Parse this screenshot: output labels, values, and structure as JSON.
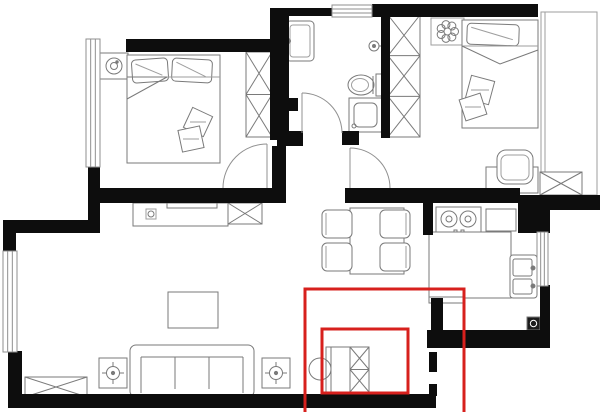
{
  "canvas": {
    "w": 600,
    "h": 412,
    "bg": "#ffffff"
  },
  "palette": {
    "wall": "#0d0d0d",
    "furniture_line": "#7a7a7a",
    "furniture_line_light": "#9e9e9e",
    "window_line": "#8f8f8f",
    "door_line": "#909090",
    "highlight": "#d7201d",
    "drain_fill": "#1c1c1c",
    "white": "#ffffff"
  },
  "walls": [
    {
      "name": "wall-bedroom1-top",
      "x": 126,
      "y": 39,
      "w": 147,
      "h": 13
    },
    {
      "name": "wall-bathroom-left",
      "x": 270,
      "y": 8,
      "w": 19,
      "h": 132
    },
    {
      "name": "wall-bathroom-left-bump",
      "x": 289,
      "y": 98,
      "w": 9,
      "h": 13
    },
    {
      "name": "wall-bathroom-top",
      "x": 289,
      "y": 8,
      "w": 44,
      "h": 8
    },
    {
      "name": "wall-top-right",
      "x": 372,
      "y": 4,
      "w": 166,
      "h": 13
    },
    {
      "name": "wall-bathroom-right",
      "x": 381,
      "y": 15,
      "w": 9,
      "h": 123
    },
    {
      "name": "wall-bathroom-bottom-left-pier",
      "x": 277,
      "y": 131,
      "w": 26,
      "h": 15
    },
    {
      "name": "wall-bathroom-bottom-right-pier",
      "x": 342,
      "y": 131,
      "w": 17,
      "h": 14
    },
    {
      "name": "wall-corridor-left-pier",
      "x": 272,
      "y": 146,
      "w": 14,
      "h": 57
    },
    {
      "name": "wall-living-top",
      "x": 97,
      "y": 188,
      "w": 189,
      "h": 15
    },
    {
      "name": "wall-bedroom1-left-lower",
      "x": 88,
      "y": 165,
      "w": 12,
      "h": 55
    },
    {
      "name": "wall-left-step",
      "x": 3,
      "y": 220,
      "w": 97,
      "h": 13
    },
    {
      "name": "wall-left-above-window",
      "x": 3,
      "y": 233,
      "w": 13,
      "h": 20
    },
    {
      "name": "wall-left-below-window",
      "x": 8,
      "y": 351,
      "w": 14,
      "h": 49
    },
    {
      "name": "wall-bottom",
      "x": 8,
      "y": 394,
      "w": 428,
      "h": 14
    },
    {
      "name": "wall-entry-jamb-upper",
      "x": 429,
      "y": 352,
      "w": 8,
      "h": 20
    },
    {
      "name": "wall-entry-jamb-lower",
      "x": 429,
      "y": 384,
      "w": 8,
      "h": 12
    },
    {
      "name": "wall-bedroom2-bottom",
      "x": 345,
      "y": 188,
      "w": 175,
      "h": 15
    },
    {
      "name": "wall-balcony-bottom",
      "x": 518,
      "y": 195,
      "w": 82,
      "h": 15
    },
    {
      "name": "wall-kitchen-corner-block",
      "x": 518,
      "y": 203,
      "w": 32,
      "h": 30
    },
    {
      "name": "wall-kitchen-left-pier",
      "x": 423,
      "y": 193,
      "w": 10,
      "h": 42
    },
    {
      "name": "wall-kitchen-lower-left",
      "x": 431,
      "y": 298,
      "w": 12,
      "h": 35
    },
    {
      "name": "wall-kitchen-bottom",
      "x": 427,
      "y": 330,
      "w": 123,
      "h": 18
    },
    {
      "name": "wall-kitchen-right-lower",
      "x": 540,
      "y": 285,
      "w": 10,
      "h": 47
    }
  ],
  "windows": [
    {
      "name": "window-bedroom1-left",
      "x": 86,
      "y": 39,
      "w": 14,
      "h": 128,
      "o": "v"
    },
    {
      "name": "window-living-left",
      "x": 3,
      "y": 251,
      "w": 14,
      "h": 101,
      "o": "v"
    },
    {
      "name": "window-bathroom-top",
      "x": 332,
      "y": 5,
      "w": 40,
      "h": 12,
      "o": "h"
    },
    {
      "name": "window-kitchen-right",
      "x": 537,
      "y": 232,
      "w": 11,
      "h": 54,
      "o": "v"
    }
  ],
  "doors": [
    {
      "name": "door-bedroom1",
      "leaf": [
        267,
        188,
        267,
        144
      ],
      "arc": "M223,188 A44,44 0 0 1 267,144"
    },
    {
      "name": "door-bathroom",
      "leaf": [
        302,
        133,
        302,
        93
      ],
      "arc": "M302,93 A40,40 0 0 1 342,133"
    },
    {
      "name": "door-bedroom2",
      "leaf": [
        350,
        188,
        350,
        148
      ],
      "arc": "M350,148 A40,40 0 0 1 390,188"
    }
  ],
  "furniture": [
    {
      "name": "balcony-outline",
      "t": "balcony",
      "x": 541,
      "y": 12,
      "w": 56,
      "h": 183
    },
    {
      "name": "nightstand-lamp",
      "t": "lampstand",
      "x": 100,
      "y": 53,
      "w": 28,
      "h": 26
    },
    {
      "name": "double-bed",
      "t": "bed",
      "x": 127,
      "y": 55,
      "w": 93,
      "h": 108,
      "pillows": [
        {
          "x": 132,
          "y": 59,
          "w": 36,
          "h": 23,
          "r": -4
        },
        {
          "x": 172,
          "y": 59,
          "w": 40,
          "h": 23,
          "r": 3
        }
      ],
      "blanket_y": 77,
      "fold": [
        [
          127,
          77
        ],
        [
          167,
          77
        ],
        [
          127,
          99
        ]
      ],
      "throws": [
        {
          "cx": 198,
          "cy": 122,
          "s": 22,
          "r": 25
        },
        {
          "cx": 191,
          "cy": 139,
          "s": 22,
          "r": -12
        }
      ]
    },
    {
      "name": "wardrobe-bedroom1",
      "t": "xcab",
      "x": 246,
      "y": 52,
      "w": 26,
      "h": 85,
      "cells": 2,
      "dir": "v"
    },
    {
      "name": "bathroom-sink",
      "t": "bathsink",
      "x": 286,
      "y": 21,
      "w": 28,
      "h": 40
    },
    {
      "name": "shower-head",
      "t": "shower",
      "cx": 374,
      "cy": 46,
      "r": 5
    },
    {
      "name": "toilet",
      "t": "toilet",
      "x": 347,
      "y": 74,
      "w": 37,
      "h": 22
    },
    {
      "name": "washing-machine",
      "t": "washer",
      "x": 349,
      "y": 98,
      "w": 33,
      "h": 34
    },
    {
      "name": "wardrobe-bedroom2",
      "t": "xcab",
      "x": 388,
      "y": 15,
      "w": 32,
      "h": 122,
      "cells": 3,
      "dir": "v"
    },
    {
      "name": "plant-pot",
      "t": "flower",
      "x": 431,
      "y": 18,
      "w": 33,
      "h": 27
    },
    {
      "name": "single-bed",
      "t": "bed",
      "x": 462,
      "y": 20,
      "w": 76,
      "h": 108,
      "pillows": [
        {
          "x": 467,
          "y": 24,
          "w": 52,
          "h": 21,
          "r": 2
        }
      ],
      "blanket_y": 46,
      "fold": [
        [
          462,
          46
        ],
        [
          500,
          64
        ],
        [
          538,
          50
        ]
      ],
      "throws": [
        {
          "cx": 480,
          "cy": 90,
          "s": 24,
          "r": 15
        },
        {
          "cx": 473,
          "cy": 107,
          "s": 22,
          "r": -18
        }
      ]
    },
    {
      "name": "desk",
      "t": "rect",
      "x": 486,
      "y": 167,
      "w": 52,
      "h": 26
    },
    {
      "name": "desk-chair",
      "t": "deskchair",
      "x": 497,
      "y": 150,
      "w": 36,
      "h": 34
    },
    {
      "name": "balcony-cabinet",
      "t": "xcab",
      "x": 540,
      "y": 172,
      "w": 42,
      "h": 23,
      "cells": 1,
      "dir": "h"
    },
    {
      "name": "tv-bench",
      "t": "tvbench",
      "x": 133,
      "y": 203,
      "w": 95,
      "h": 23
    },
    {
      "name": "soundbar",
      "t": "rect",
      "x": 167,
      "y": 203,
      "w": 50,
      "h": 5
    },
    {
      "name": "sideboard",
      "t": "xcab",
      "x": 228,
      "y": 203,
      "w": 34,
      "h": 21,
      "cells": 1,
      "dir": "h"
    },
    {
      "name": "coffee-table",
      "t": "rect",
      "x": 168,
      "y": 292,
      "w": 50,
      "h": 36
    },
    {
      "name": "sofa",
      "t": "sofa",
      "x": 130,
      "y": 345,
      "w": 124,
      "h": 52
    },
    {
      "name": "plant-stand-left",
      "t": "plantstand",
      "x": 99,
      "y": 358,
      "w": 28,
      "h": 30
    },
    {
      "name": "plant-stand-right",
      "t": "plantstand",
      "x": 262,
      "y": 358,
      "w": 28,
      "h": 30
    },
    {
      "name": "low-cabinet",
      "t": "xcab",
      "x": 25,
      "y": 377,
      "w": 62,
      "h": 20,
      "cells": 1,
      "dir": "h"
    },
    {
      "name": "dining-table",
      "t": "rect",
      "x": 350,
      "y": 208,
      "w": 54,
      "h": 66
    },
    {
      "name": "dining-chair",
      "t": "chair",
      "x": 322,
      "y": 210,
      "w": 30,
      "h": 28,
      "back": "l"
    },
    {
      "name": "dining-chair",
      "t": "chair",
      "x": 380,
      "y": 210,
      "w": 30,
      "h": 28,
      "back": "r"
    },
    {
      "name": "dining-chair",
      "t": "chair",
      "x": 322,
      "y": 243,
      "w": 30,
      "h": 28,
      "back": "l"
    },
    {
      "name": "dining-chair",
      "t": "chair",
      "x": 380,
      "y": 243,
      "w": 30,
      "h": 28,
      "back": "r"
    },
    {
      "name": "stove",
      "t": "stove",
      "x": 436,
      "y": 207,
      "w": 45,
      "h": 27
    },
    {
      "name": "cutting-board",
      "t": "rect",
      "x": 486,
      "y": 209,
      "w": 30,
      "h": 22
    },
    {
      "name": "kitchen-counter",
      "t": "rect",
      "x": 429,
      "y": 232,
      "w": 82,
      "h": 66
    },
    {
      "name": "kitchen-sink",
      "t": "ksink",
      "x": 510,
      "y": 255,
      "w": 27,
      "h": 43
    },
    {
      "name": "floor-drain",
      "t": "drain",
      "x": 527,
      "y": 317,
      "w": 13,
      "h": 13
    },
    {
      "name": "entry-ledge",
      "t": "rect",
      "x": 429,
      "y": 297,
      "w": 36,
      "h": 6
    },
    {
      "name": "shoe-cabinet-open-panel",
      "t": "panel",
      "x": 326,
      "y": 347,
      "w": 24,
      "h": 45
    },
    {
      "name": "shoe-cabinet",
      "t": "xcab",
      "x": 350,
      "y": 347,
      "w": 19,
      "h": 45,
      "cells": 2,
      "dir": "v"
    },
    {
      "name": "entry-circle-symbol",
      "t": "circle",
      "cx": 320,
      "cy": 369,
      "r": 11
    }
  ],
  "highlights": [
    {
      "name": "highlight-entry-area-outer",
      "x": 305,
      "y": 289,
      "w": 159,
      "h": 132
    },
    {
      "name": "highlight-shoe-cabinet-inner",
      "x": 322,
      "y": 329,
      "w": 86,
      "h": 64
    }
  ]
}
